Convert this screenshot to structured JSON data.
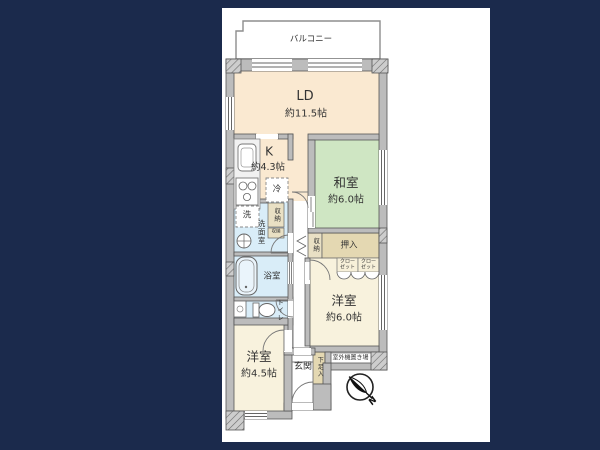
{
  "canvas": {
    "background": "#1b2a4c",
    "paper": "#ffffff"
  },
  "palette": {
    "wall_fill": "#bcbcbc",
    "wall_edge": "#555555",
    "cream": "#fae9d1",
    "cream_light": "#f8f2dd",
    "tatami_green": "#cfe6c3",
    "sanitary_blue": "#d9edf8",
    "closet_tan": "#e4d8b2",
    "text": "#333333"
  },
  "labels": {
    "balcony": "バルコニー",
    "living_dining": {
      "name": "LD",
      "area": "約11.5帖"
    },
    "kitchen": {
      "name": "K",
      "area": "約4.3帖"
    },
    "refrigerator": "冷",
    "japanese_room": {
      "name": "和室",
      "area": "約6.0帖"
    },
    "washer": "洗",
    "washroom": "洗面室",
    "storage_hall_upper": "収納",
    "storage_hall_lower": "収納",
    "storage_corridor": "収納",
    "oshiire": "押入",
    "closet_left": {
      "line1": "クロー",
      "line2": "ゼット"
    },
    "closet_right": {
      "line1": "クロー",
      "line2": "ゼット"
    },
    "bathroom": "浴室",
    "toilet": "トイレ",
    "western_room_6": {
      "name": "洋室",
      "area": "約6.0帖"
    },
    "western_room_45": {
      "name": "洋室",
      "area": "約4.5帖"
    },
    "entrance": "玄関",
    "shoe_cabinet": "下足入",
    "outdoor_unit_area": "室外機置き場",
    "compass_north": "N"
  }
}
